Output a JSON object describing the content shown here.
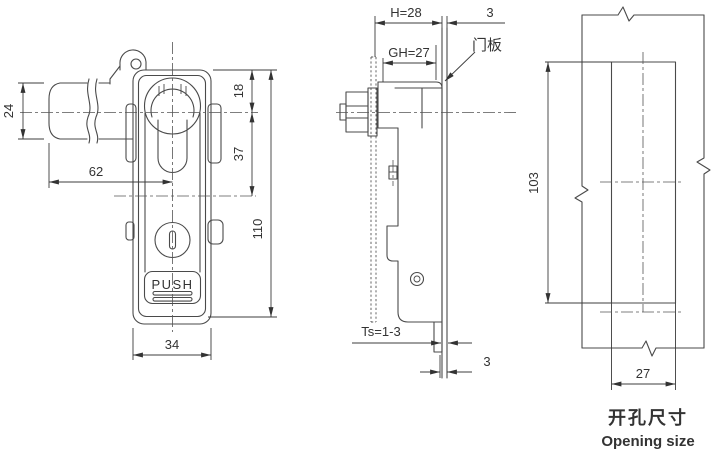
{
  "colors": {
    "background": "#ffffff",
    "line": "#4a4a4a",
    "dimension": "#3c3c3c",
    "text": "#333333"
  },
  "front_view": {
    "push_label": "PUSH",
    "dims": {
      "handle_height": "24",
      "handle_length": "62",
      "top_to_center": "18",
      "center_to_mid": "37",
      "body_height": "110",
      "body_width": "34"
    }
  },
  "side_view": {
    "door_panel_label": "门板",
    "dims": {
      "mount_depth": "H=28",
      "grip_depth": "GH=27",
      "front_gap": "3",
      "panel_thickness": "Ts=1-3",
      "rear_gap": "3"
    }
  },
  "opening_view": {
    "title_cn": "开孔尺寸",
    "title_en": "Opening size",
    "dims": {
      "height": "103",
      "width": "27"
    }
  }
}
